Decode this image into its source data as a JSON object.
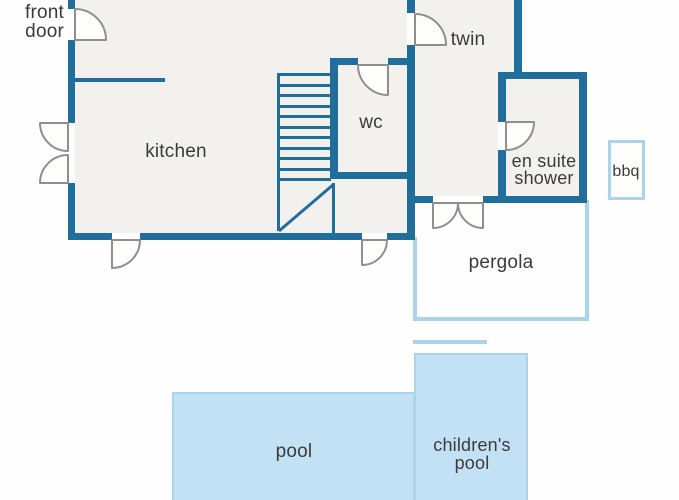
{
  "title": "villa floor plan",
  "colors": {
    "wall": "#1f6e9c",
    "light_blue": "#aad4ea",
    "pool_fill": "#c3e1f5",
    "room_fill": "#f2f1ee",
    "text": "#3b3b3b",
    "door": "#8f8f8f",
    "bg": "#fefefe"
  },
  "labels": {
    "front_door": [
      "front",
      "door"
    ],
    "kitchen": "kitchen",
    "wc": "wc",
    "twin": "twin",
    "en_suite": [
      "en suite",
      "shower"
    ],
    "bbq": "bbq",
    "pergola": "pergola",
    "pool": "pool",
    "childrens_pool": [
      "children's",
      "pool"
    ]
  },
  "stairs": {
    "tread_count": 11
  }
}
